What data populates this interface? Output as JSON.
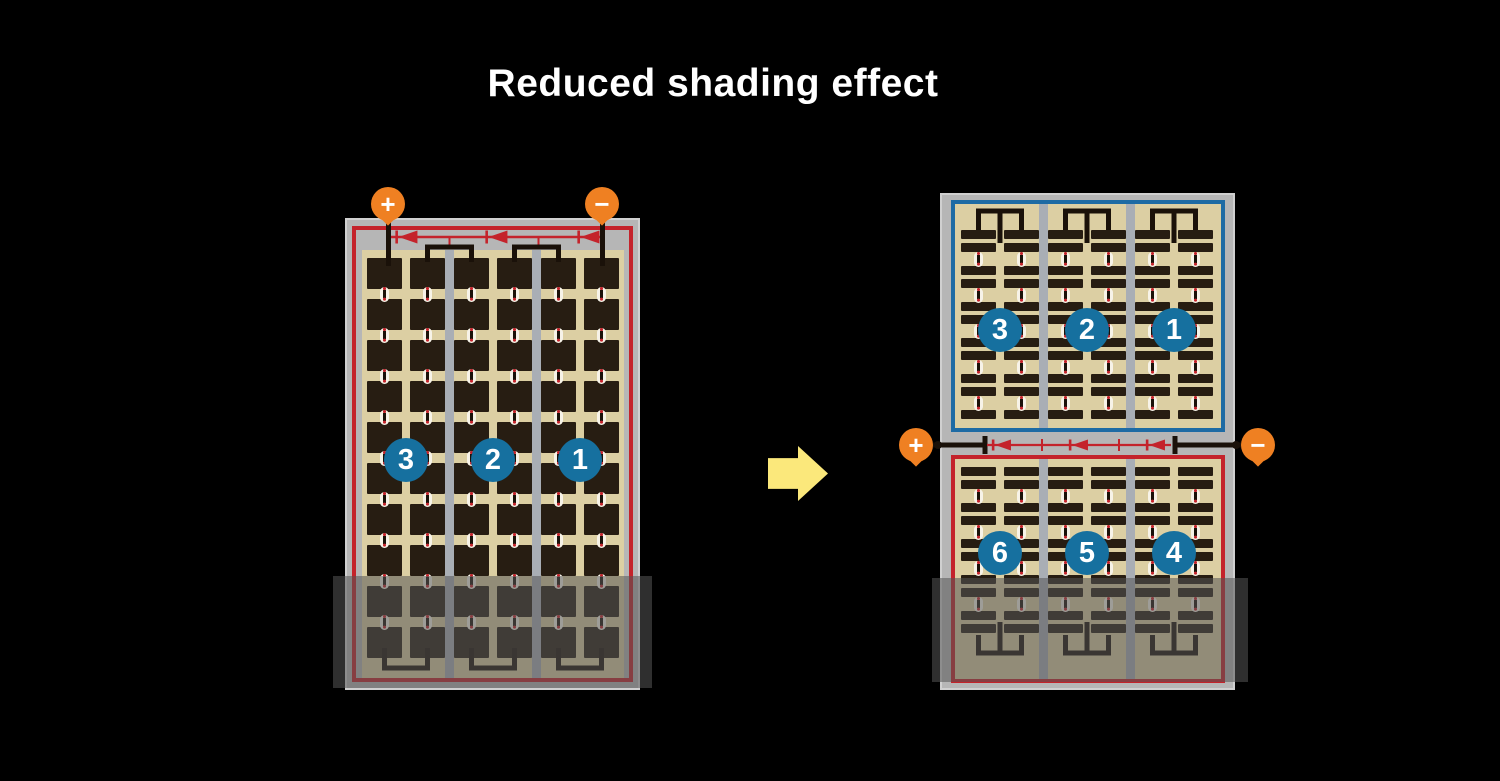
{
  "title": "Reduced shading effect",
  "left_module": {
    "terminals": {
      "positive": "+",
      "negative": "−"
    },
    "string_numbers": [
      "3",
      "2",
      "1"
    ]
  },
  "right_module": {
    "terminals": {
      "positive": "+",
      "negative": "−"
    },
    "top_string_numbers": [
      "3",
      "2",
      "1"
    ],
    "bottom_string_numbers": [
      "6",
      "5",
      "4"
    ]
  },
  "icons": {
    "transform_arrow": "right-block-arrow",
    "bypass_diode": "left-pointing-diode",
    "plus_terminal": "+",
    "minus_terminal": "−"
  },
  "colors": {
    "background": "#000000",
    "title_text": "#ffffff",
    "module_frame": "#b6b6b6",
    "frame_edge": "#d0d0d0",
    "cell_field": "#dccfa3",
    "cell": "#271d12",
    "bus_black": "#1a1109",
    "circuit_red": "#c4232b",
    "border_blue": "#1e6ba4",
    "badge_blue": "#16709f",
    "terminal_orange": "#ef8022",
    "section_divider": "#a9aeb5",
    "connector_white": "#f7f3e8",
    "shading_overlay": "rgba(85,85,85,0.55)",
    "arrow_yellow": "#fbe87b",
    "number_text": "#ffffff"
  }
}
